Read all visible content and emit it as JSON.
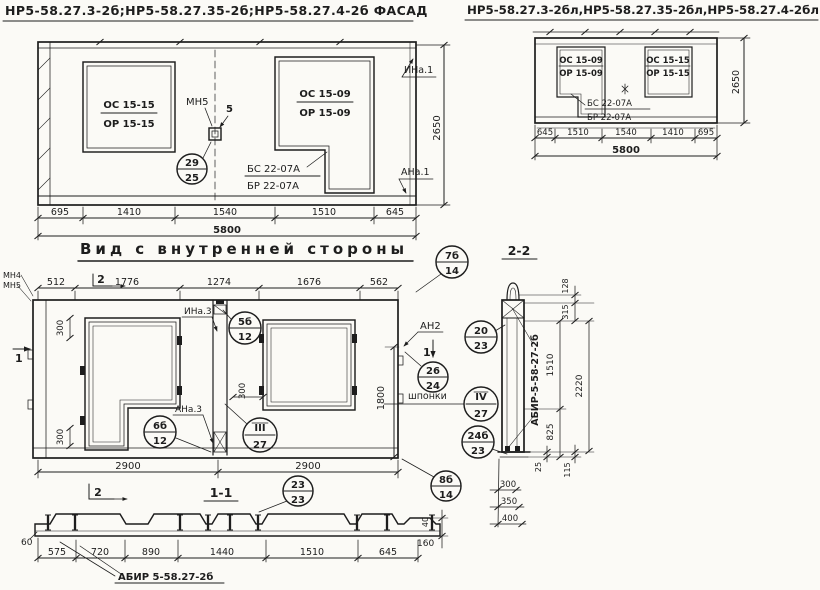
{
  "colors": {
    "paper": "#fbfaf6",
    "ink": "#1d1d1d"
  },
  "facade_left": {
    "title": "НР5-58.27.3-2б;НР5-58.27.35-2б;НР5-58.27.4-2б ФАСАД",
    "window_left": {
      "top": "ОС 15-15",
      "bottom": "ОР 15-15"
    },
    "window_right": {
      "top": "ОС 15-09",
      "bottom": "ОР 15-09"
    },
    "mount_label": "МН5",
    "mount_num": "5",
    "circle": {
      "top": "29",
      "bottom": "25"
    },
    "beam_top": "БС 22-07А",
    "beam_bottom": "БР 22-07А",
    "anchor_top": "ИНа.1",
    "anchor_bottom": "АНа.1",
    "height": "2650",
    "dims": [
      "695",
      "1410",
      "1540",
      "1510",
      "645"
    ],
    "total": "5800"
  },
  "facade_right": {
    "title": "НР5-58.27.3-2бл,НР5-58.27.35-2бл,НР5-58.27.4-2бл ФАСАД",
    "window_left": {
      "top": "ОС 15-09",
      "bottom": "ОР 15-09"
    },
    "window_right": {
      "top": "ОС 15-15",
      "bottom": "ОР 15-15"
    },
    "beam_top": "БС 22-07А",
    "beam_bottom": "БР 22-07А",
    "height": "2650",
    "dims": [
      "645",
      "1510",
      "1540",
      "1410",
      "695"
    ],
    "total": "5800"
  },
  "inner_view": {
    "title": "Вид с внутренней стороны",
    "top_dims": [
      "512",
      "1776",
      "1274",
      "1676",
      "562"
    ],
    "bottom_dim": "2900",
    "flag_section2": "2",
    "flag_section1": "1",
    "corner_labels": {
      "mn4": "МН4",
      "mn5": "МН5"
    },
    "anchor_top": "ИНа.3",
    "anchor_bottom": "АНа.3",
    "anchor_right": "АН2",
    "keys_label": "шпонки",
    "dim300": "300",
    "dim1800": "1800",
    "circles": {
      "c7b": {
        "top": "7б",
        "bottom": "14"
      },
      "c5b": {
        "top": "5б",
        "bottom": "12"
      },
      "c6b": {
        "top": "6б",
        "bottom": "12"
      },
      "c3": {
        "top": "III",
        "bottom": "27"
      },
      "c26": {
        "top": "26",
        "bottom": "24"
      },
      "c20": {
        "top": "20",
        "bottom": "23"
      },
      "c4": {
        "top": "IV",
        "bottom": "27"
      },
      "c24b": {
        "top": "24б",
        "bottom": "23"
      },
      "c8b": {
        "top": "8б",
        "bottom": "14"
      },
      "c23": {
        "top": "23",
        "bottom": "23"
      }
    }
  },
  "section_1_1": {
    "title": "1-1",
    "dims": [
      "575",
      "720",
      "890",
      "1440",
      "1510",
      "645"
    ],
    "dim_left": "60",
    "dim_right": "160",
    "dim_rib": "40",
    "label": "АБИР 5-58.27-2б"
  },
  "section_2_2": {
    "title": "2-2",
    "dims": {
      "d128": "128",
      "d315": "315",
      "d1510": "1510",
      "d2220": "2220",
      "d825": "825",
      "d25": "25",
      "d115": "115",
      "d300": "300",
      "d350": "350",
      "d400": "400"
    },
    "label": "АБИР-5-58-27-2б"
  }
}
